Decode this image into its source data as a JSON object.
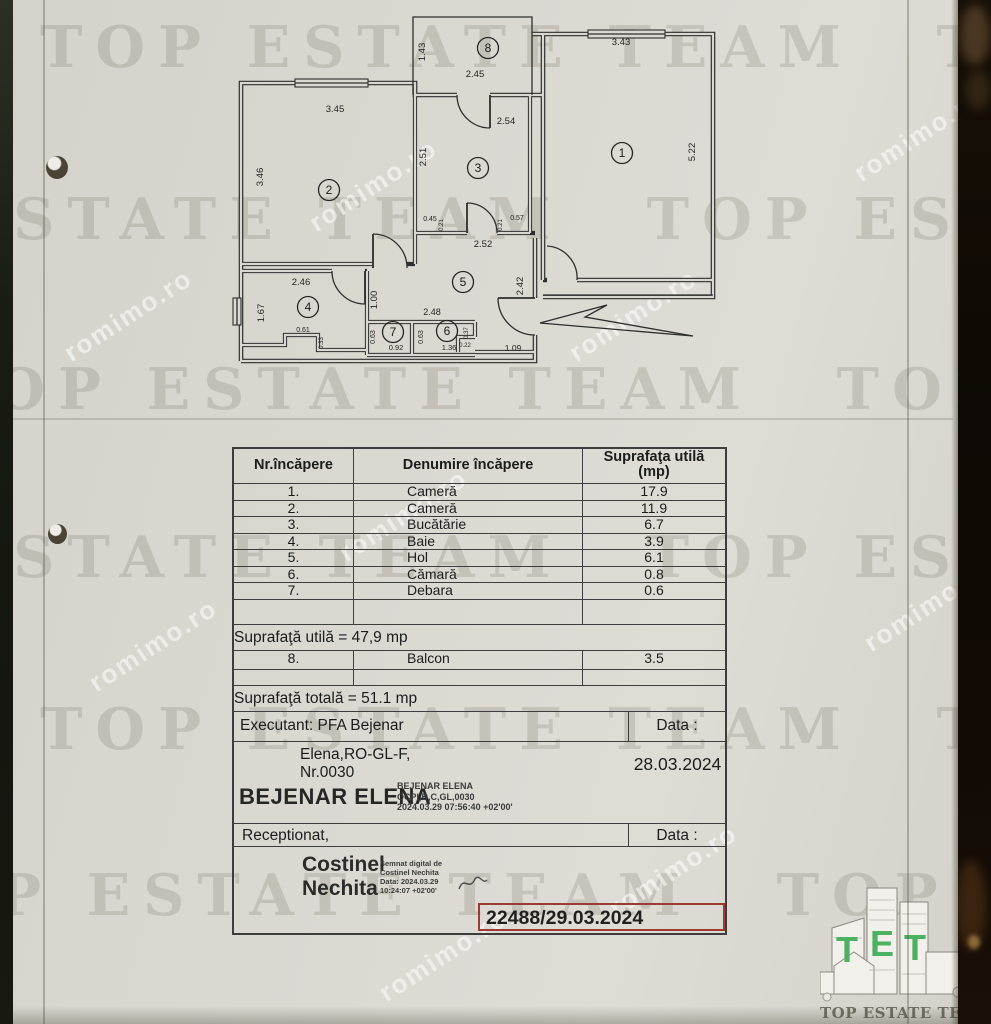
{
  "watermark": {
    "big_text": "TOP ESTATE TEAM",
    "diag_text": "romimo.ro"
  },
  "plan": {
    "rooms": [
      {
        "n": "1",
        "x": 397,
        "y": 148
      },
      {
        "n": "2",
        "x": 104,
        "y": 185
      },
      {
        "n": "3",
        "x": 253,
        "y": 163
      },
      {
        "n": "4",
        "x": 83,
        "y": 302
      },
      {
        "n": "5",
        "x": 238,
        "y": 277
      },
      {
        "n": "6",
        "x": 222,
        "y": 326
      },
      {
        "n": "7",
        "x": 168,
        "y": 327
      },
      {
        "n": "8",
        "x": 263,
        "y": 43
      }
    ],
    "dims": [
      {
        "t": "1.43",
        "x": 200,
        "y": 47,
        "v": 1,
        "s": 9.5
      },
      {
        "t": "2.45",
        "x": 250,
        "y": 72,
        "s": 9.5
      },
      {
        "t": "3.43",
        "x": 396,
        "y": 40,
        "s": 9.5
      },
      {
        "t": "5.22",
        "x": 470,
        "y": 147,
        "v": 1,
        "s": 9.5
      },
      {
        "t": "3.45",
        "x": 110,
        "y": 107,
        "s": 9.5
      },
      {
        "t": "3.46",
        "x": 38,
        "y": 172,
        "v": 1,
        "s": 9.5
      },
      {
        "t": "2.54",
        "x": 281,
        "y": 119,
        "s": 9.5
      },
      {
        "t": "2.51",
        "x": 201,
        "y": 152,
        "v": 1,
        "s": 9.5
      },
      {
        "t": "0.45",
        "x": 205,
        "y": 216,
        "s": 7
      },
      {
        "t": "0.21",
        "x": 218,
        "y": 220,
        "v": 1,
        "s": 6
      },
      {
        "t": "0.21",
        "x": 277,
        "y": 220,
        "v": 1,
        "s": 6
      },
      {
        "t": "0.57",
        "x": 292,
        "y": 215,
        "s": 7
      },
      {
        "t": "2.52",
        "x": 258,
        "y": 242,
        "s": 9.5
      },
      {
        "t": "2.42",
        "x": 298,
        "y": 281,
        "v": 1,
        "s": 9.5
      },
      {
        "t": "2.46",
        "x": 76,
        "y": 280,
        "s": 9.5
      },
      {
        "t": "1.67",
        "x": 39,
        "y": 308,
        "v": 1,
        "s": 9.5
      },
      {
        "t": "1.00",
        "x": 152,
        "y": 295,
        "v": 1,
        "s": 9.5
      },
      {
        "t": "0.61",
        "x": 78,
        "y": 327,
        "s": 7
      },
      {
        "t": "0.33",
        "x": 98,
        "y": 338,
        "v": 1,
        "s": 6
      },
      {
        "t": "0.63",
        "x": 150,
        "y": 332,
        "v": 1,
        "s": 7
      },
      {
        "t": "0.92",
        "x": 171,
        "y": 345,
        "s": 7.5
      },
      {
        "t": "0.63",
        "x": 198,
        "y": 332,
        "v": 1,
        "s": 7
      },
      {
        "t": "1.36",
        "x": 224,
        "y": 345,
        "s": 7.5
      },
      {
        "t": "0.37",
        "x": 243,
        "y": 328,
        "v": 1,
        "s": 6
      },
      {
        "t": "0.22",
        "x": 240,
        "y": 342,
        "s": 6
      },
      {
        "t": "2.48",
        "x": 207,
        "y": 310,
        "s": 9
      },
      {
        "t": "1.09",
        "x": 288,
        "y": 346,
        "s": 8.5
      }
    ]
  },
  "table": {
    "col1_header": "Nr.încăpere",
    "col2_header": "Denumire încăpere",
    "col3_header_line1": "Suprafaţa utilă",
    "col3_header_line2": "(mp)",
    "rows": [
      {
        "nr": "1.",
        "name": "Cameră",
        "area": "17.9"
      },
      {
        "nr": "2.",
        "name": "Cameră",
        "area": "11.9"
      },
      {
        "nr": "3.",
        "name": "Bucătărie",
        "area": "6.7"
      },
      {
        "nr": "4.",
        "name": "Baie",
        "area": "3.9"
      },
      {
        "nr": "5.",
        "name": "Hol",
        "area": "6.1"
      },
      {
        "nr": "6.",
        "name": "Cămară",
        "area": "0.8"
      },
      {
        "nr": "7.",
        "name": "Debara",
        "area": "0.6"
      }
    ],
    "subtotal": "Suprafaţă utilă = 47,9 mp",
    "balcony": {
      "nr": "8.",
      "name": "Balcon",
      "area": "3.5"
    },
    "total": "Suprafaţă totală = 51.1 mp"
  },
  "footer": {
    "executant": "Executant: PFA Bejenar",
    "executant_line2": "Elena,RO-GL-F,",
    "executant_line3": "Nr.0030",
    "data_label_1": "Data :",
    "date_value": "28.03.2024",
    "signer1_name": "BEJENAR ELENA",
    "signer1_cert_line1": "BEJENAR ELENA",
    "signer1_cert_line2": "OCPI,B,C,GL,0030",
    "signer1_cert_line3": "2024.03.29 07:56:40 +02'00'",
    "received": "Receptionat,",
    "data_label_2": "Data :",
    "signer2_first": "Costinel",
    "signer2_last": "Nechita",
    "signer2_cert_line1": "Semnat digital de",
    "signer2_cert_line2": "Costinel Nechita",
    "signer2_cert_line3": "Data: 2024.03.29",
    "signer2_cert_line4": "10:24:07 +02'00'",
    "registration": "22488/29.03.2024"
  },
  "logo": {
    "caption": "TOP ESTATE TEAM",
    "letters": [
      "T",
      "E",
      "T"
    ],
    "green": "#4db163"
  },
  "colors": {
    "paper": "#d9d7d0",
    "stamp_red": "#9c3a33"
  }
}
